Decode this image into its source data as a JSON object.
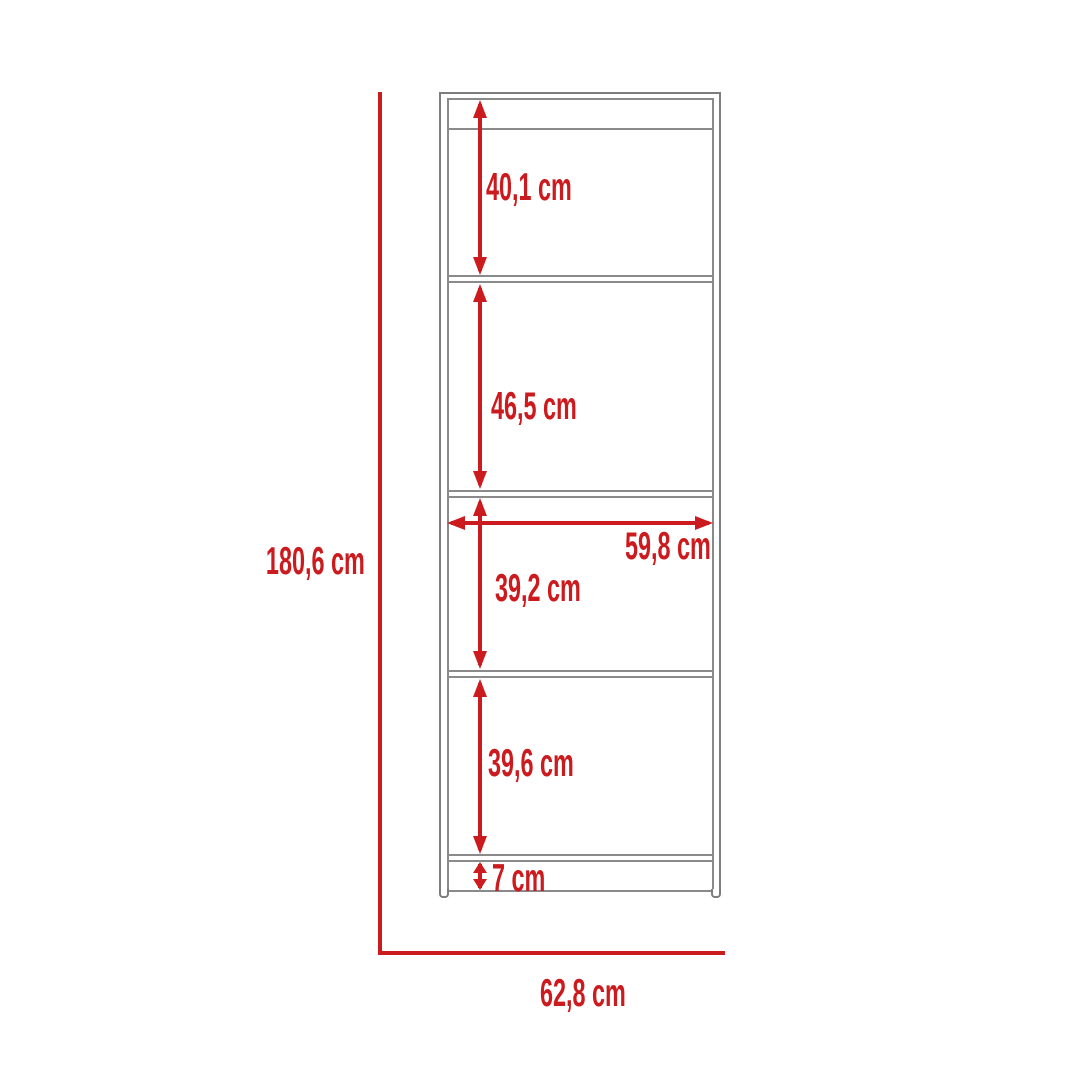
{
  "unit": "cm",
  "dimensions": {
    "overall_height": "180,6 cm",
    "overall_width": "62,8 cm",
    "usable_width": "59,8 cm",
    "shelf_space_1": "40,1 cm",
    "shelf_space_2": "46,5 cm",
    "shelf_space_3": "39,2 cm",
    "shelf_space_4": "39,6 cm",
    "base_height": "7 cm"
  },
  "colors": {
    "dimension_red": "#CC1B1E",
    "furniture_line_gray": "#8a8a8a",
    "background": "#ffffff"
  }
}
